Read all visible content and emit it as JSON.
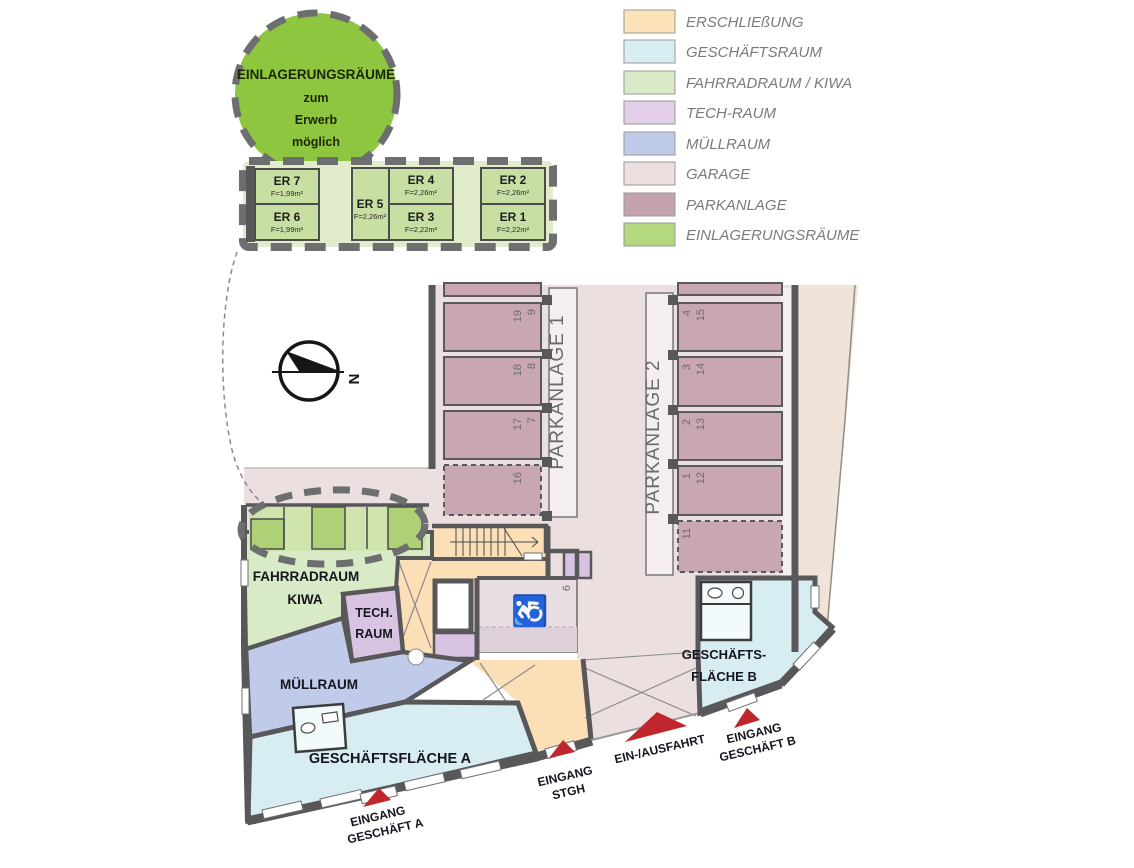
{
  "detail_callout": {
    "title": "EINLAGERUNGSRÄUME",
    "line2": "zum",
    "line3": "Erwerb",
    "line4": "möglich",
    "circle_color": "#8ec63f"
  },
  "storage_rooms": [
    {
      "name": "ER 7",
      "area": "F=1,99m²"
    },
    {
      "name": "ER 6",
      "area": "F=1,99m²"
    },
    {
      "name": "ER 5",
      "area": "F=2,26m²"
    },
    {
      "name": "ER 4",
      "area": "F=2,26m²"
    },
    {
      "name": "ER 3",
      "area": "F=2,22m²"
    },
    {
      "name": "ER 2",
      "area": "F=2,26m²"
    },
    {
      "name": "ER 1",
      "area": "F=2,22m²"
    }
  ],
  "legend": {
    "items": [
      {
        "label": "ERSCHLIEßUNG",
        "color": "#fce3b9"
      },
      {
        "label": "GESCHÄFTSRAUM",
        "color": "#d7edf2"
      },
      {
        "label": "FAHRRADRAUM / KIWA",
        "color": "#d9eac6"
      },
      {
        "label": "TECH-RAUM",
        "color": "#e3cfe8"
      },
      {
        "label": "MÜLLRAUM",
        "color": "#bfcbe9"
      },
      {
        "label": "GARAGE",
        "color": "#ecdfde"
      },
      {
        "label": "PARKANLAGE",
        "color": "#c5a3ad"
      },
      {
        "label": "EINLAGERUNGSRÄUME",
        "color": "#b3d880"
      }
    ]
  },
  "compass": {
    "north_label": "N"
  },
  "parking": {
    "p1": {
      "label": "PARKANLAGE 1",
      "spaces": [
        {
          "a": "19",
          "b": "9"
        },
        {
          "a": "18",
          "b": "8"
        },
        {
          "a": "17",
          "b": "7"
        },
        {
          "a": "16",
          "b": ""
        }
      ]
    },
    "p2": {
      "label": "PARKANLAGE 2",
      "spaces": [
        {
          "a": "4",
          "b": "15"
        },
        {
          "a": "3",
          "b": "14"
        },
        {
          "a": "2",
          "b": "13"
        },
        {
          "a": "1",
          "b": "12"
        },
        {
          "a": "11",
          "b": ""
        }
      ]
    },
    "handicap_space": "6",
    "wheelchair_icon": "♿"
  },
  "rooms": {
    "fahrradraum_line1": "FAHRRADRAUM",
    "fahrradraum_line2": "KIWA",
    "tech_line1": "TECH.",
    "tech_line2": "RAUM",
    "muellraum": "MÜLLRAUM",
    "geschaeft_a": "GESCHÄFTSFLÄCHE A",
    "geschaeft_b_line1": "GESCHÄFTS-",
    "geschaeft_b_line2": "FLÄCHE B"
  },
  "entrances": {
    "a_line1": "EINGANG",
    "a_line2": "GESCHÄFT A",
    "stgh_line1": "EINGANG",
    "stgh_line2": "STGH",
    "einausfahrt": "EIN-/AUSFAHRT",
    "b_line1": "EINGANG",
    "b_line2": "GESCHÄFT B",
    "arrow_color": "#c0272d"
  }
}
